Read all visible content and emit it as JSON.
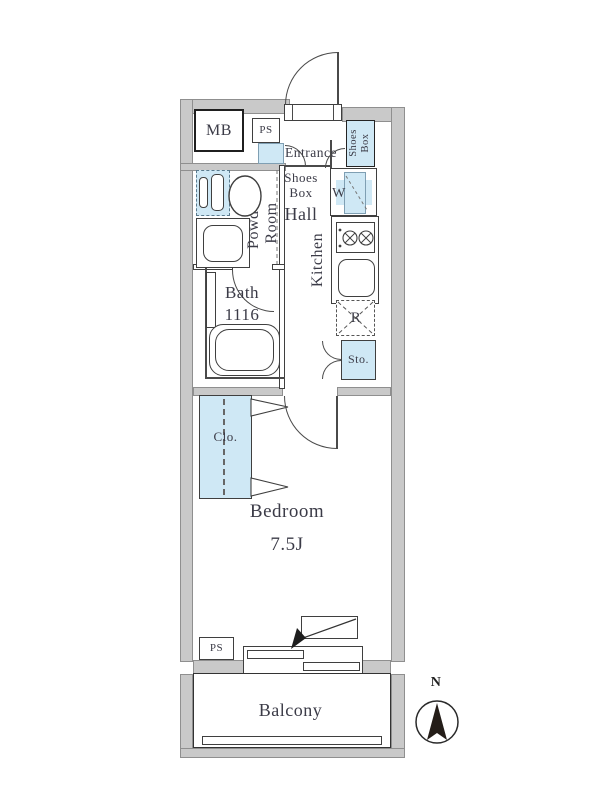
{
  "floorplan": {
    "labels": {
      "mb": "MB",
      "ps_top": "PS",
      "entrance": "Entrance",
      "shoes_box_line1": "Shoes",
      "shoes_box_line2": "Box",
      "hall": "Hall",
      "powder_line1": "Powder",
      "powder_line2": "Room",
      "bath_line1": "Bath",
      "bath_line2": "1116",
      "washer": "W",
      "kitchen": "Kitchen",
      "refrigerator": "R",
      "storage": "Sto.",
      "closet": "Clo.",
      "bedroom": "Bedroom",
      "bedroom_size": "7.5J",
      "ps_bottom": "PS",
      "balcony": "Balcony",
      "compass_north": "N"
    },
    "colors": {
      "wall_gray": "#c9c9c9",
      "fixture_blue": "#cfe8f5",
      "line": "#3f3f3f",
      "text": "#3b3b47"
    }
  }
}
